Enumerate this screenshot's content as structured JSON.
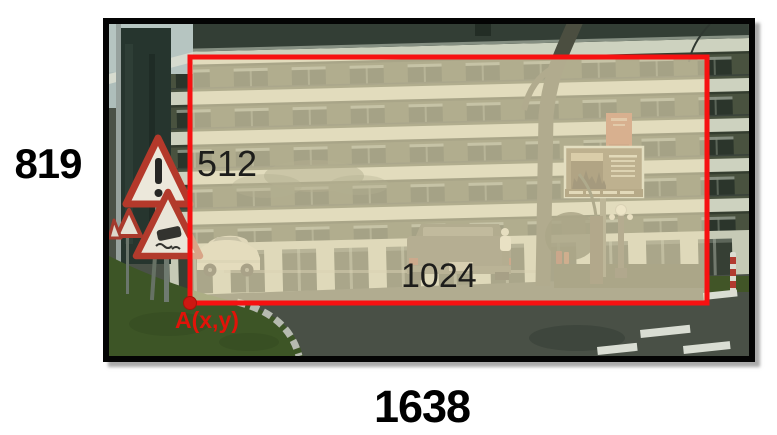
{
  "figure": {
    "outer": {
      "height_label": "819",
      "width_label": "1638"
    },
    "crop": {
      "height_label": "512",
      "width_label": "1024",
      "anchor_label": "A(x,y)"
    },
    "colors": {
      "crop_border": "#f71111",
      "crop_tint": "#eee3bd",
      "anchor_text": "#e11309",
      "frame_border": "#040404"
    }
  }
}
